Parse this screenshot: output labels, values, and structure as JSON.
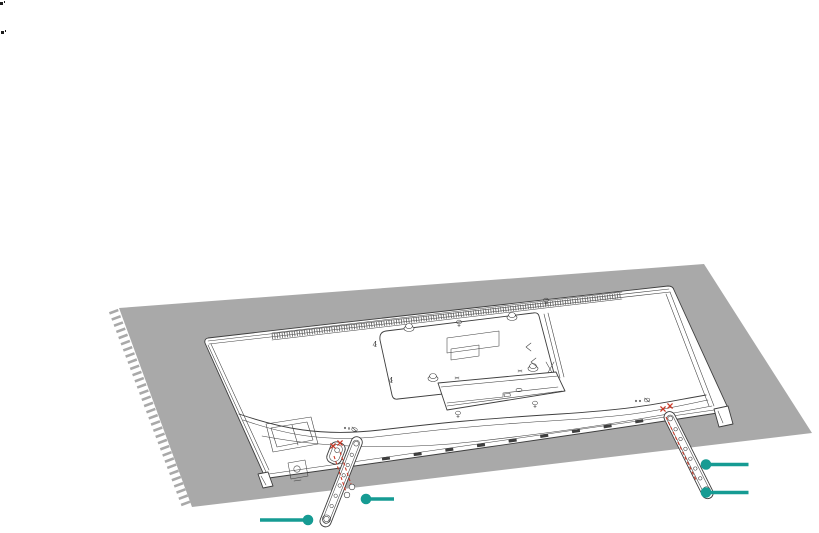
{
  "illustration": {
    "part_labels": {
      "vesa_label_upper": "4",
      "vesa_label_lower": "4"
    },
    "colors": {
      "accent_teal": "#169b93",
      "guide_red": "#cc3a28",
      "mat_gray": "#a9a9a9",
      "line_dark": "#3e3e3e",
      "background": "#ffffff"
    },
    "callouts": [
      {
        "id": "right-stand-callout-upper"
      },
      {
        "id": "right-stand-callout-lower"
      },
      {
        "id": "left-stand-callout-upper"
      },
      {
        "id": "left-stand-callout-lower"
      }
    ]
  }
}
